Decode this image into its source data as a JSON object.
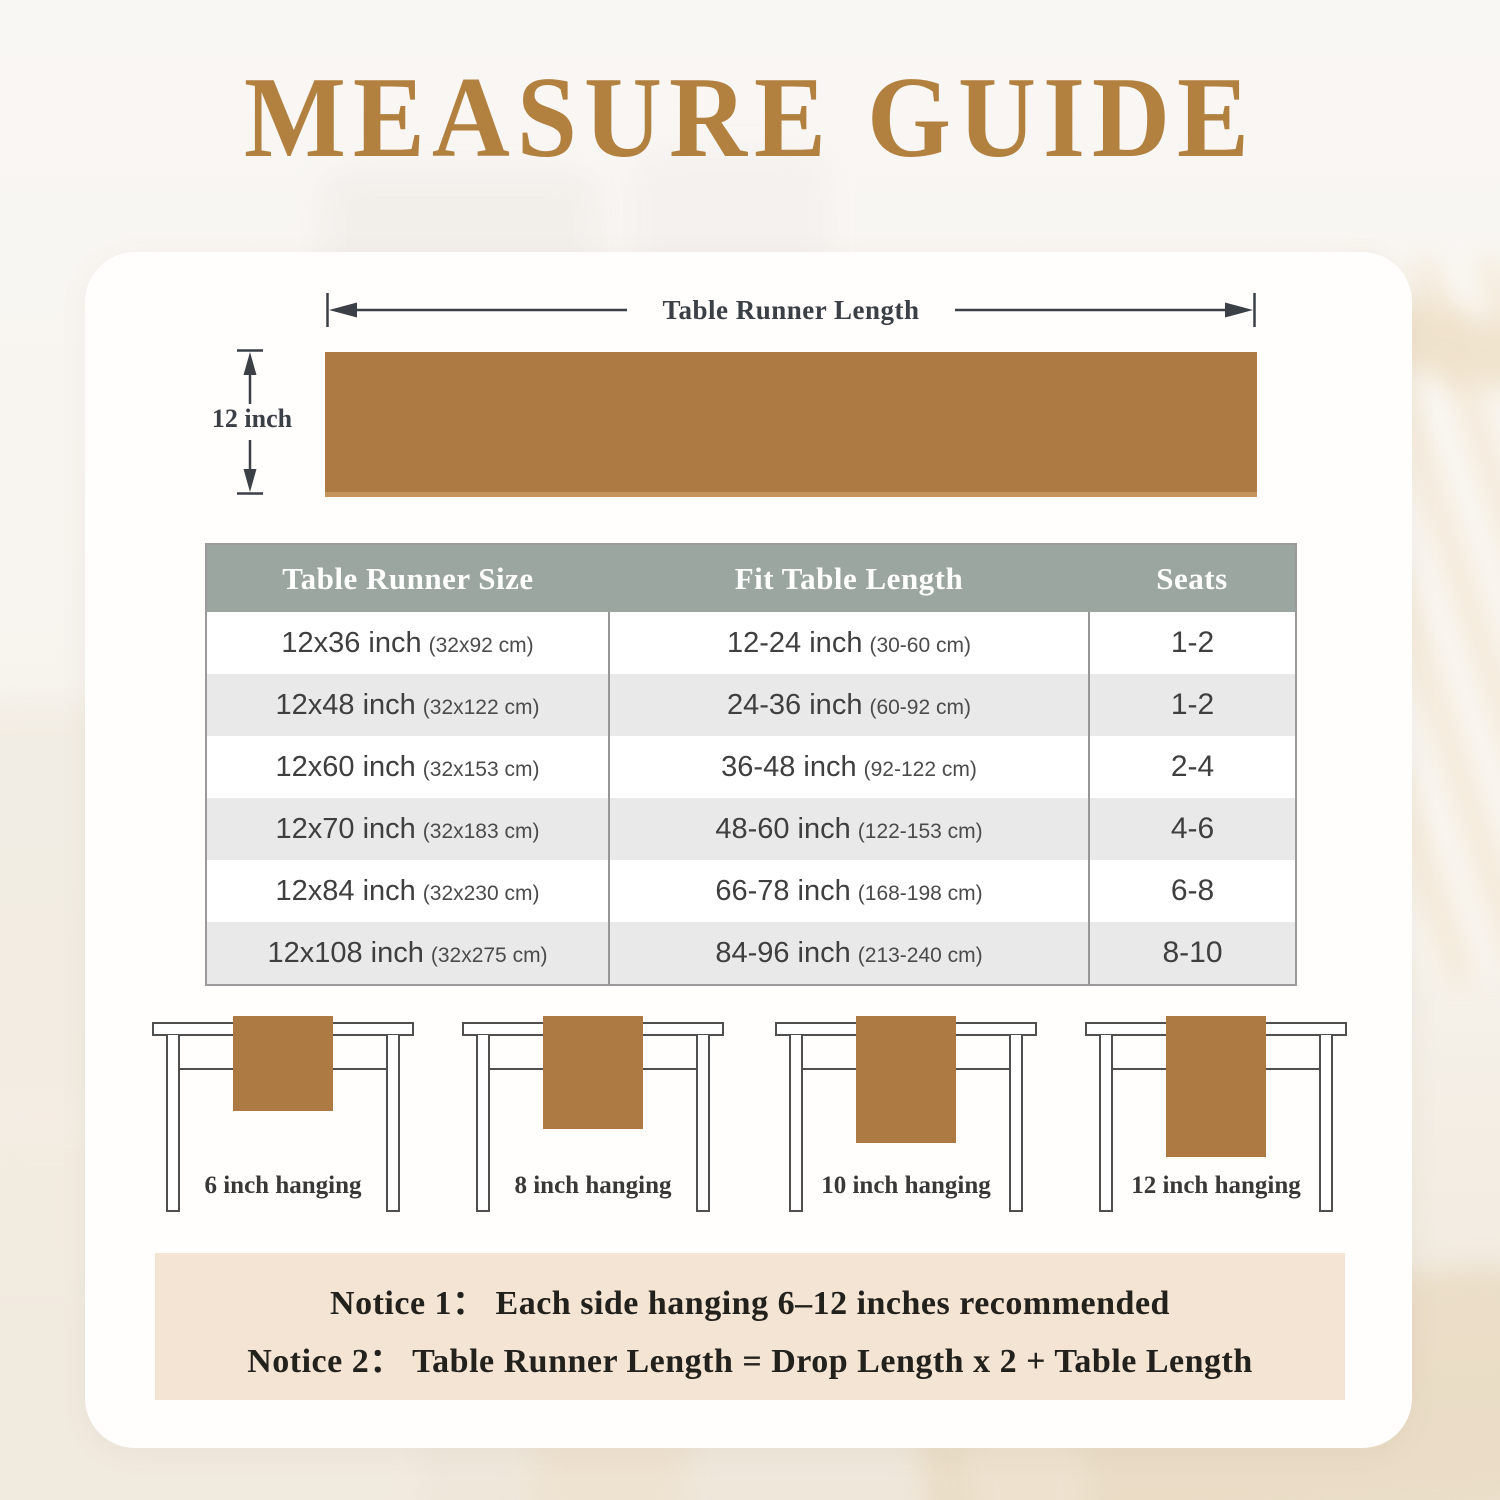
{
  "title": "MEASURE GUIDE",
  "diagram": {
    "length_label": "Table Runner Length",
    "width_label": "12 inch"
  },
  "size_table": {
    "headers": [
      "Table Runner Size",
      "Fit Table Length",
      "Seats"
    ],
    "rows": [
      {
        "size": "12x36 inch",
        "size_cm": "(32x92 cm)",
        "fit": "12-24 inch",
        "fit_cm": "(30-60 cm)",
        "seats": "1-2"
      },
      {
        "size": "12x48 inch",
        "size_cm": "(32x122 cm)",
        "fit": "24-36 inch",
        "fit_cm": "(60-92 cm)",
        "seats": "1-2"
      },
      {
        "size": "12x60 inch",
        "size_cm": "(32x153 cm)",
        "fit": "36-48 inch",
        "fit_cm": "(92-122 cm)",
        "seats": "2-4"
      },
      {
        "size": "12x70 inch",
        "size_cm": "(32x183 cm)",
        "fit": "48-60 inch",
        "fit_cm": "(122-153 cm)",
        "seats": "4-6"
      },
      {
        "size": "12x84 inch",
        "size_cm": "(32x230 cm)",
        "fit": "66-78 inch",
        "fit_cm": "(168-198 cm)",
        "seats": "6-8"
      },
      {
        "size": "12x108 inch",
        "size_cm": "(32x275 cm)",
        "fit": "84-96 inch",
        "fit_cm": "(213-240 cm)",
        "seats": "8-10"
      }
    ]
  },
  "hanging_examples": [
    {
      "label": "6 inch hanging",
      "drop_inches": 6
    },
    {
      "label": "8 inch hanging",
      "drop_inches": 8
    },
    {
      "label": "10 inch hanging",
      "drop_inches": 10
    },
    {
      "label": "12 inch hanging",
      "drop_inches": 12
    }
  ],
  "notices": [
    "Notice 1： Each side hanging 6–12 inches recommended",
    "Notice 2： Table Runner Length = Drop Length x 2 + Table Length"
  ],
  "colors": {
    "title_gold": "#b28140",
    "runner_brown": "#ad7a44",
    "table_header_bg": "#9ca6a0",
    "row_alt_bg": "#e9e9ea",
    "notice_bg": "#f4e4d3",
    "line_dark": "#3b4046"
  }
}
